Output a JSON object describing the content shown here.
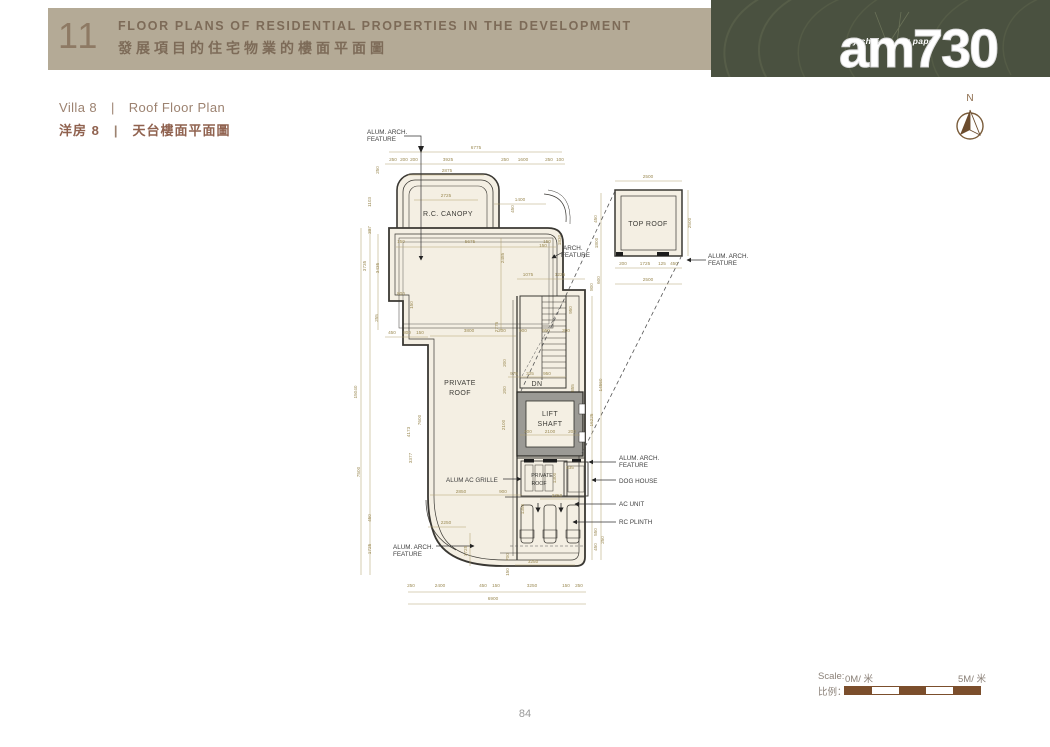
{
  "header": {
    "number": "11",
    "title_en": "FLOOR PLANS OF RESIDENTIAL PROPERTIES IN THE DEVELOPMENT",
    "title_zh": "發展項目的住宅物業的樓面平面圖"
  },
  "brand": {
    "tagline": "my choice . my paper",
    "logo": "am730"
  },
  "subtitle": {
    "villa_en": "Villa 8",
    "divider": "|",
    "plan_en": "Roof Floor Plan",
    "villa_zh": "洋房 8",
    "plan_zh": "天台樓面平面圖"
  },
  "compass": {
    "label": "N"
  },
  "scale_bar": {
    "label_en": "Scale:",
    "label_zh": "比例：",
    "start": "0M/ 米",
    "end": "5M/ 米"
  },
  "page_number": "84",
  "colors": {
    "band": "#b4aa96",
    "banner_green": "#4a5140",
    "scale_brown": "#7b4e2c",
    "wall": "#3a3833",
    "plan_fill": "#f4efe3",
    "dim_text": "#9c8b55"
  },
  "plan": {
    "texts": [
      {
        "k": "room",
        "t": "PRIVATE",
        "x": 460,
        "y": 385
      },
      {
        "k": "room",
        "t": "ROOF",
        "x": 460,
        "y": 395
      },
      {
        "k": "room",
        "t": "R.C. CANOPY",
        "x": 448,
        "y": 216
      },
      {
        "k": "room",
        "t": "TOP ROOF",
        "x": 648,
        "y": 226
      },
      {
        "k": "room",
        "t": "LIFT",
        "x": 550,
        "y": 416
      },
      {
        "k": "room",
        "t": "SHAFT",
        "x": 550,
        "y": 426
      },
      {
        "k": "room",
        "t": "DN",
        "x": 537,
        "y": 386
      },
      {
        "k": "rooms",
        "t": "PRIVATE",
        "x": 542,
        "y": 477
      },
      {
        "k": "rooms",
        "t": "ROOF",
        "x": 539,
        "y": 485
      },
      {
        "k": "lead",
        "t": "ALUM. ARCH.",
        "x": 367,
        "y": 134
      },
      {
        "k": "lead",
        "t": "FEATURE",
        "x": 367,
        "y": 141
      },
      {
        "k": "lead",
        "t": "ARCH.",
        "x": 563,
        "y": 250
      },
      {
        "k": "lead",
        "t": "FEATURE",
        "x": 561,
        "y": 257
      },
      {
        "k": "lead",
        "t": "ALUM AC GRILLE",
        "x": 446,
        "y": 482
      },
      {
        "k": "lead",
        "t": "ALUM. ARCH.",
        "x": 619,
        "y": 460
      },
      {
        "k": "lead",
        "t": "FEATURE",
        "x": 619,
        "y": 467
      },
      {
        "k": "lead",
        "t": "DOG HOUSE",
        "x": 619,
        "y": 483
      },
      {
        "k": "lead",
        "t": "AC UNIT",
        "x": 619,
        "y": 506
      },
      {
        "k": "lead",
        "t": "RC PLINTH",
        "x": 619,
        "y": 524
      },
      {
        "k": "lead",
        "t": "ALUM. ARCH.",
        "x": 393,
        "y": 549
      },
      {
        "k": "lead",
        "t": "FEATURE",
        "x": 393,
        "y": 556
      },
      {
        "k": "lead",
        "t": "ALUM. ARCH.",
        "x": 708,
        "y": 258
      },
      {
        "k": "lead",
        "t": "FEATURE",
        "x": 708,
        "y": 265
      },
      {
        "t": "6775",
        "x": 476,
        "y": 149
      },
      {
        "t": "250",
        "x": 393,
        "y": 161
      },
      {
        "t": "200",
        "x": 404,
        "y": 161
      },
      {
        "t": "200",
        "x": 414,
        "y": 161
      },
      {
        "t": "3925",
        "x": 448,
        "y": 161
      },
      {
        "t": "250",
        "x": 505,
        "y": 161
      },
      {
        "t": "1600",
        "x": 523,
        "y": 161
      },
      {
        "t": "250",
        "x": 549,
        "y": 161
      },
      {
        "t": "100",
        "x": 560,
        "y": 161
      },
      {
        "t": "2875",
        "x": 447,
        "y": 172
      },
      {
        "t": "2725",
        "x": 446,
        "y": 197
      },
      {
        "t": "1400",
        "x": 520,
        "y": 201
      },
      {
        "t": "150",
        "x": 543,
        "y": 247
      },
      {
        "t": "1103",
        "x": 371,
        "y": 202,
        "r": 1
      },
      {
        "t": "397",
        "x": 371,
        "y": 230,
        "r": 1
      },
      {
        "t": "250",
        "x": 379,
        "y": 170,
        "r": 1
      },
      {
        "t": "450",
        "x": 514,
        "y": 209,
        "r": 1
      },
      {
        "t": "1830",
        "x": 561,
        "y": 240,
        "r": 1
      },
      {
        "t": "450",
        "x": 597,
        "y": 219,
        "r": 1
      },
      {
        "t": "1800",
        "x": 598,
        "y": 243,
        "r": 1
      },
      {
        "t": "600",
        "x": 600,
        "y": 280,
        "r": 1
      },
      {
        "t": "15040",
        "x": 357,
        "y": 392,
        "r": 1
      },
      {
        "t": "3735",
        "x": 366,
        "y": 266,
        "r": 1
      },
      {
        "t": "7500",
        "x": 360,
        "y": 472,
        "r": 1
      },
      {
        "t": "450",
        "x": 371,
        "y": 518,
        "r": 1
      },
      {
        "t": "1725",
        "x": 371,
        "y": 549,
        "r": 1
      },
      {
        "t": "3435",
        "x": 379,
        "y": 268,
        "r": 1
      },
      {
        "t": "800",
        "x": 401,
        "y": 295
      },
      {
        "t": "150",
        "x": 413,
        "y": 305,
        "r": 1
      },
      {
        "t": "255",
        "x": 378,
        "y": 318,
        "r": 1
      },
      {
        "t": "450",
        "x": 392,
        "y": 334
      },
      {
        "t": "800",
        "x": 407,
        "y": 334
      },
      {
        "t": "150",
        "x": 420,
        "y": 334
      },
      {
        "t": "4173",
        "x": 410,
        "y": 432,
        "r": 1
      },
      {
        "t": "7600",
        "x": 421,
        "y": 420,
        "r": 1
      },
      {
        "t": "3377",
        "x": 412,
        "y": 458,
        "r": 1
      },
      {
        "t": "5675",
        "x": 470,
        "y": 243
      },
      {
        "t": "150",
        "x": 401,
        "y": 243
      },
      {
        "t": "150",
        "x": 547,
        "y": 243
      },
      {
        "t": "2485",
        "x": 504,
        "y": 258,
        "r": 1
      },
      {
        "t": "3800",
        "x": 469,
        "y": 332
      },
      {
        "t": "2775",
        "x": 498,
        "y": 327,
        "r": 1
      },
      {
        "t": "1075",
        "x": 528,
        "y": 276
      },
      {
        "t": "1225",
        "x": 560,
        "y": 276
      },
      {
        "t": "200",
        "x": 502,
        "y": 332
      },
      {
        "t": "900",
        "x": 523,
        "y": 332
      },
      {
        "t": "950",
        "x": 546,
        "y": 332
      },
      {
        "t": "200",
        "x": 566,
        "y": 332
      },
      {
        "t": "975",
        "x": 514,
        "y": 375
      },
      {
        "t": "325",
        "x": 530,
        "y": 375
      },
      {
        "t": "950",
        "x": 547,
        "y": 375
      },
      {
        "t": "950",
        "x": 572,
        "y": 310,
        "r": 1
      },
      {
        "t": "855",
        "x": 574,
        "y": 388,
        "r": 1
      },
      {
        "t": "200",
        "x": 506,
        "y": 363,
        "r": 1
      },
      {
        "t": "2100",
        "x": 505,
        "y": 425,
        "r": 1
      },
      {
        "t": "200",
        "x": 506,
        "y": 390,
        "r": 1
      },
      {
        "t": "200",
        "x": 528,
        "y": 433
      },
      {
        "t": "2100",
        "x": 550,
        "y": 433
      },
      {
        "t": "200",
        "x": 572,
        "y": 433
      },
      {
        "t": "16225",
        "x": 593,
        "y": 420,
        "r": 1
      },
      {
        "t": "14560",
        "x": 602,
        "y": 385,
        "r": 1
      },
      {
        "t": "800",
        "x": 593,
        "y": 287,
        "r": 1
      },
      {
        "t": "2850",
        "x": 461,
        "y": 493
      },
      {
        "t": "900",
        "x": 503,
        "y": 493
      },
      {
        "t": "2350",
        "x": 557,
        "y": 497
      },
      {
        "t": "1350",
        "x": 524,
        "y": 509,
        "r": 1
      },
      {
        "t": "535",
        "x": 570,
        "y": 469
      },
      {
        "t": "1300",
        "x": 556,
        "y": 478,
        "r": 1
      },
      {
        "t": "2250",
        "x": 446,
        "y": 524
      },
      {
        "t": "1725",
        "x": 467,
        "y": 551,
        "r": 1
      },
      {
        "t": "700",
        "x": 509,
        "y": 557,
        "r": 1
      },
      {
        "t": "150",
        "x": 509,
        "y": 572,
        "r": 1
      },
      {
        "t": "3250",
        "x": 533,
        "y": 563
      },
      {
        "t": "550",
        "x": 597,
        "y": 532,
        "r": 1
      },
      {
        "t": "450",
        "x": 597,
        "y": 547,
        "r": 1
      },
      {
        "t": "250",
        "x": 604,
        "y": 540,
        "r": 1
      },
      {
        "t": "250",
        "x": 411,
        "y": 587
      },
      {
        "t": "2400",
        "x": 440,
        "y": 587
      },
      {
        "t": "450",
        "x": 483,
        "y": 587
      },
      {
        "t": "150",
        "x": 496,
        "y": 587
      },
      {
        "t": "3250",
        "x": 532,
        "y": 587
      },
      {
        "t": "150",
        "x": 566,
        "y": 587
      },
      {
        "t": "250",
        "x": 579,
        "y": 587
      },
      {
        "t": "6900",
        "x": 493,
        "y": 600
      },
      {
        "t": "2500",
        "x": 648,
        "y": 178
      },
      {
        "t": "2500",
        "x": 691,
        "y": 223,
        "r": 1
      },
      {
        "t": "200",
        "x": 623,
        "y": 265
      },
      {
        "t": "1725",
        "x": 645,
        "y": 265
      },
      {
        "t": "125",
        "x": 662,
        "y": 265
      },
      {
        "t": "450",
        "x": 674,
        "y": 265
      },
      {
        "t": "2500",
        "x": 648,
        "y": 281
      }
    ]
  }
}
